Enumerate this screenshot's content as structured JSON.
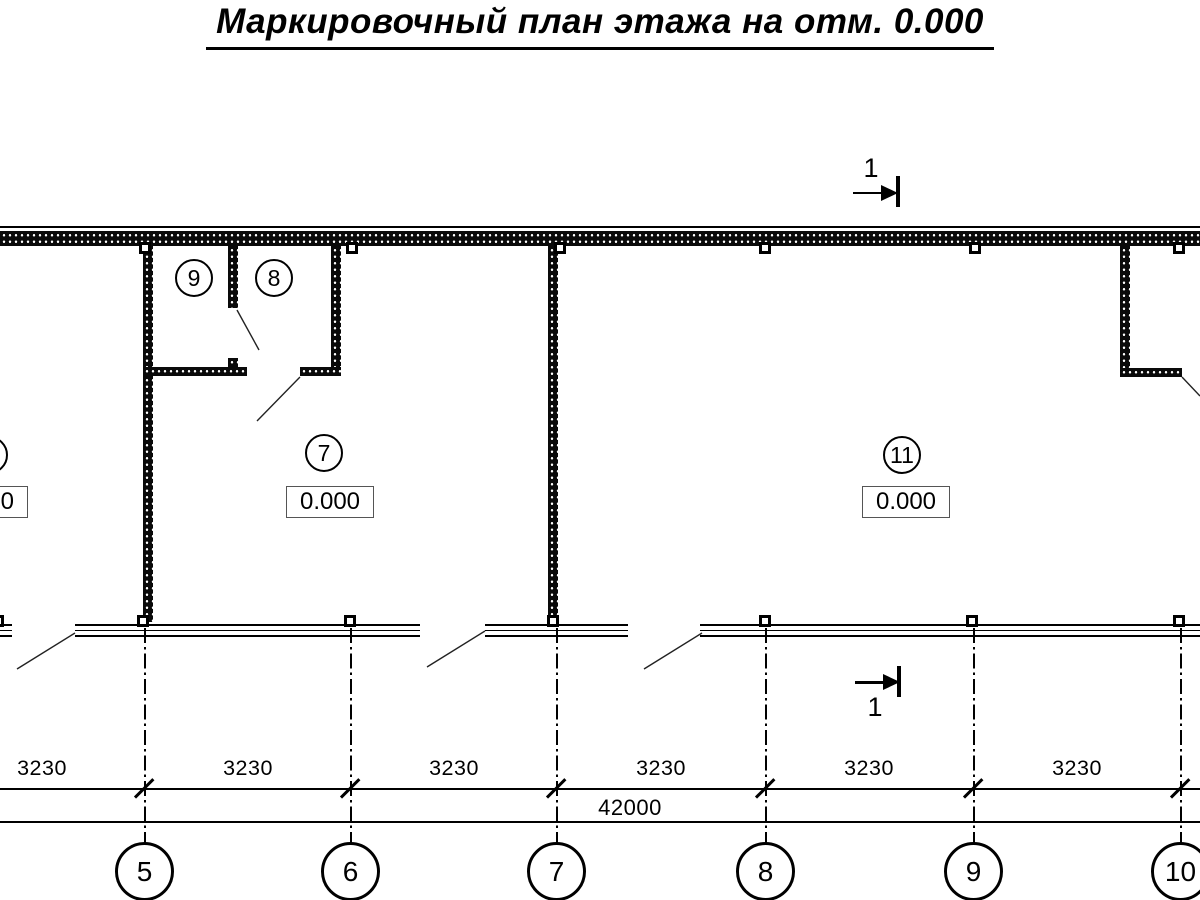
{
  "title": "Маркировочный план этажа на отм. 0.000",
  "rooms": {
    "room9": {
      "number": "9"
    },
    "room8": {
      "number": "8"
    },
    "room7": {
      "number": "7",
      "elevation": "0.000"
    },
    "room11": {
      "number": "11",
      "elevation": "0.000"
    },
    "room_left_partial": {
      "elevation": "0.000"
    }
  },
  "section_marker": {
    "label": "1"
  },
  "dimensions": {
    "bay_labels": [
      "3230",
      "3230",
      "3230",
      "3230",
      "3230",
      "3230"
    ],
    "total_label": "42000"
  },
  "axes": [
    "5",
    "6",
    "7",
    "8",
    "9",
    "10"
  ]
}
